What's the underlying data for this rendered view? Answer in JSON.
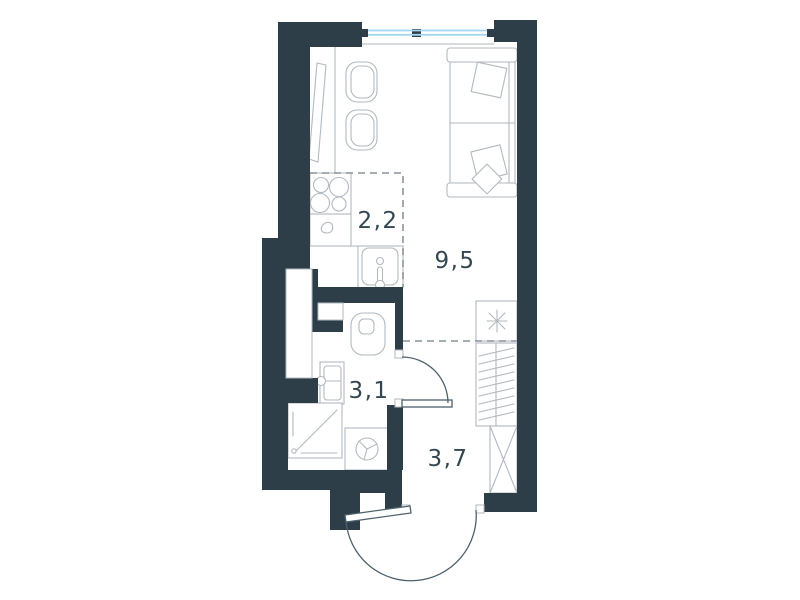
{
  "floor_plan": {
    "title": "Studio apartment floor plan",
    "rooms": [
      {
        "id": "kitchen",
        "area_label": "2,2"
      },
      {
        "id": "living-room",
        "area_label": "9,5"
      },
      {
        "id": "bathroom",
        "area_label": "3,1"
      },
      {
        "id": "hallway",
        "area_label": "3,7"
      }
    ],
    "fixtures": [
      "window",
      "dining-table",
      "chair",
      "chair",
      "sofa-bed",
      "pillow",
      "pillow",
      "stove",
      "kitchen-counter",
      "kitchen-sink",
      "refrigerator",
      "toilet",
      "bathroom-sink",
      "shower",
      "washing-machine",
      "wardrobe-hanging",
      "wardrobe-shelves",
      "bathroom-door",
      "entrance-door",
      "duct-shaft",
      "wall-niche"
    ],
    "colors": {
      "wall": "#2e3e48",
      "furniture_line": "#b2b9bf",
      "door_line": "#4f616b",
      "dashed_line": "#8a949a",
      "window_blue": "#a5d5f0",
      "label_text": "#334750",
      "background": "#ffffff"
    }
  }
}
